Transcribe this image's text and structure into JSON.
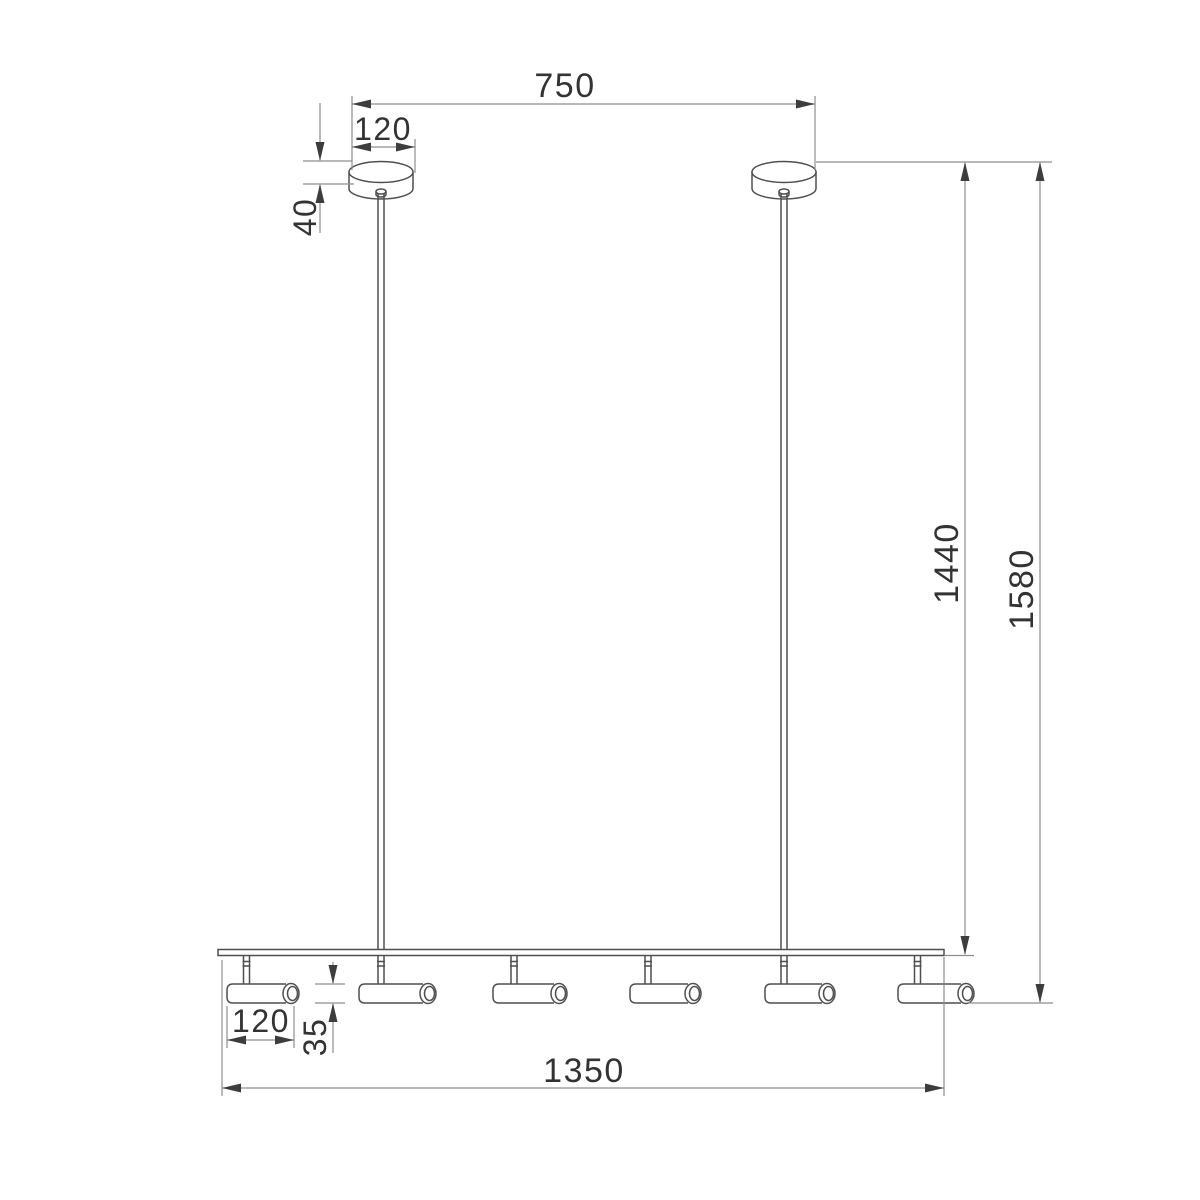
{
  "document": {
    "kind": "technical dimension drawing",
    "subject": "linear pendant luminaire: two ceiling canopies, two suspension rods, one horizontal track, six cylindrical spotlights",
    "units_implied": "mm"
  },
  "labels": {
    "span_canopies": "750",
    "canopy_diameter": "120",
    "canopy_height": "40",
    "drop_to_track": "1440",
    "overall_drop": "1580",
    "spotlight_length": "120",
    "spotlight_diameter": "35",
    "track_length": "1350"
  },
  "colors": {
    "background": "#ffffff",
    "object_line": "#4f4f4f",
    "dimension_line": "#8e8e8e",
    "arrow": "#3d3d3d",
    "text": "#333333"
  }
}
